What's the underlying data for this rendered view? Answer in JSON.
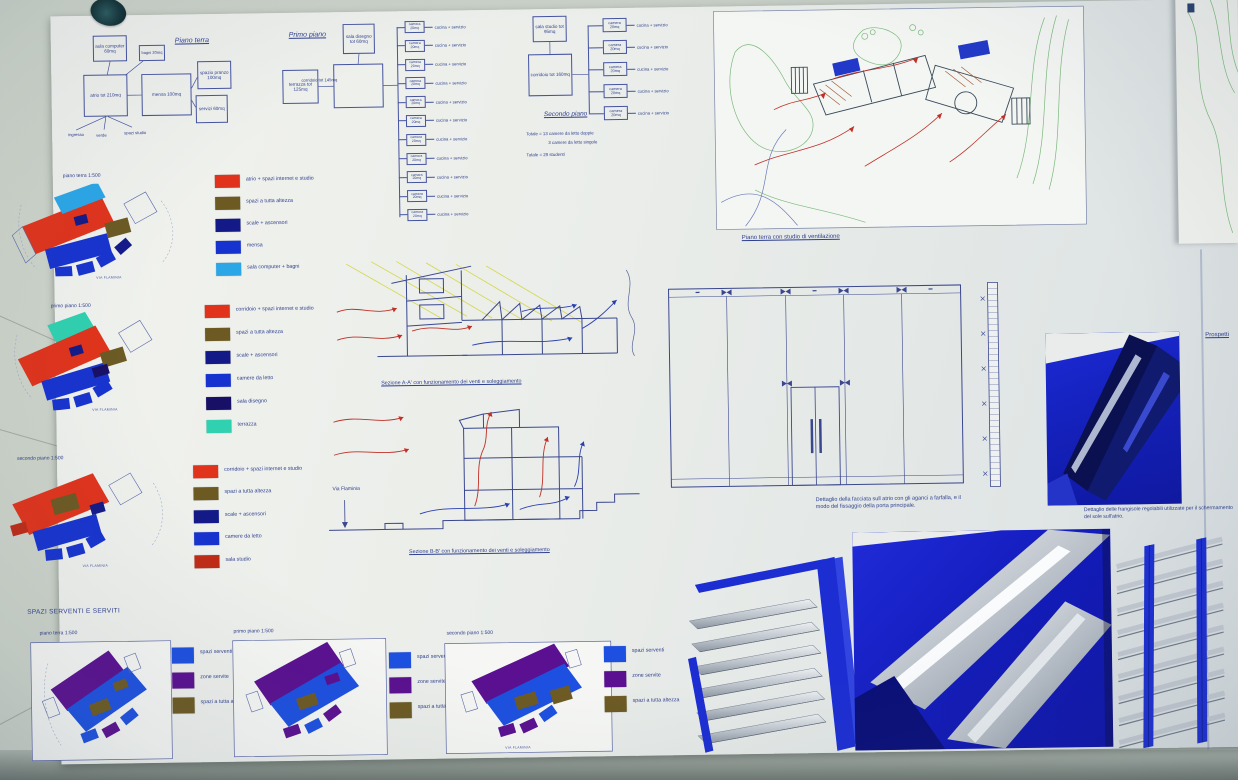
{
  "ink": "#2e3f8e",
  "org_piano_terra": {
    "title": "Piano terra",
    "rooms": {
      "aula": "aula computer 60mq",
      "bagni": "bagni 20mq",
      "atrio": "atrio tot 210mq",
      "mensa": "mensa 100mq",
      "pranzo": "spazio pranzo 100mq",
      "servizi": "servizi 60mq"
    },
    "stubs": [
      "ingresso",
      "verde",
      "spazi studio"
    ]
  },
  "org_primo_piano": {
    "title": "Primo piano",
    "rooms": {
      "sala_disegno": "sala disegno tot 60mq",
      "terrazza": "terrazza tot 125mq",
      "corridoio": "corridoio tot 145mq"
    },
    "camera_rows": [
      {
        "room": "camera 20mq",
        "service": "cucina + servizio"
      },
      {
        "room": "camera 20mq",
        "service": "cucina + servizio"
      },
      {
        "room": "camera 20mq",
        "service": "cucina + servizio"
      },
      {
        "room": "camera 20mq",
        "service": "cucina + servizio"
      },
      {
        "room": "camera 20mq",
        "service": "cucina + servizio"
      },
      {
        "room": "camera 20mq",
        "service": "cucina + servizio"
      },
      {
        "room": "camera 20mq",
        "service": "cucina + servizio"
      },
      {
        "room": "camera 20mq",
        "service": "cucina + servizio"
      },
      {
        "room": "camera 20mq",
        "service": "cucina + servizio"
      },
      {
        "room": "camera 20mq",
        "service": "cucina + servizio"
      },
      {
        "room": "camera 20mq",
        "service": "cucina + servizio"
      }
    ]
  },
  "org_secondo_piano": {
    "title": "Secondo piano",
    "rooms": {
      "sala_studio": "sala studio tot 95mq",
      "corridoio": "corridoio tot 160mq"
    },
    "camera_rows": [
      {
        "room": "camera 20mq",
        "service": "cucina + servizio"
      },
      {
        "room": "camera 20mq",
        "service": "cucina + servizio"
      },
      {
        "room": "camera 20mq",
        "service": "cucina + servizio"
      },
      {
        "room": "camera 20mq",
        "service": "cucina + servizio"
      },
      {
        "room": "camera 20mq",
        "service": "cucina + servizio"
      }
    ],
    "totals": {
      "line1": "Totale = 13 camere da letto doppie",
      "line2": "3 camere da letto singole",
      "line3": "Totale = 29 studenti"
    }
  },
  "site_plan": {
    "caption": "Piano terra con studio di ventilazione"
  },
  "colored_plans": [
    {
      "label": "piano terra 1:500",
      "road": "VIA FLAMINIA",
      "legend": [
        {
          "color": "#e1331b",
          "label": "atrio + spazi internet e studio"
        },
        {
          "color": "#6d5a23",
          "label": "spazi a tutta altezza"
        },
        {
          "color": "#131a88",
          "label": "scale + ascensori"
        },
        {
          "color": "#1733cf",
          "label": "mensa"
        },
        {
          "color": "#2ba7e8",
          "label": "sala computer + bagni"
        }
      ]
    },
    {
      "label": "primo piano 1:500",
      "road": "VIA FLAMINIA",
      "legend": [
        {
          "color": "#e1331b",
          "label": "corridoio + spazi internet e studio"
        },
        {
          "color": "#6d5a23",
          "label": "spazi a tutta altezza"
        },
        {
          "color": "#131a88",
          "label": "scale + ascensori"
        },
        {
          "color": "#1733cf",
          "label": "camere da letto"
        },
        {
          "color": "#171066",
          "label": "sala disegno"
        },
        {
          "color": "#2fd1b0",
          "label": "terrazza"
        }
      ]
    },
    {
      "label": "secondo piano 1:500",
      "road": "VIA FLAMINIA",
      "legend": [
        {
          "color": "#e1331b",
          "label": "corridoio + spazi internet e studio"
        },
        {
          "color": "#6d5a23",
          "label": "spazi a tutta altezza"
        },
        {
          "color": "#131a88",
          "label": "scale + ascensori"
        },
        {
          "color": "#1733cf",
          "label": "camere da letto"
        },
        {
          "color": "#bf2b17",
          "label": "sala studio"
        }
      ]
    }
  ],
  "sections": {
    "caption_a": "Sezione A-A' con funzionamento dei venti e soleggiamento",
    "caption_b": "Sezione B-B' con funzionamento dei venti e soleggiamento",
    "via_flaminia": "Via Flaminia"
  },
  "facade_detail": {
    "caption": "Dettaglio della facciata sull atrio con gli aganci a farfalla, e il modo del fissaggio della porta principale."
  },
  "frangisole": {
    "caption": "Dettaglio delle frangisole regolabili utilizzate per il schermamento del sole sull'atrio."
  },
  "serventi": {
    "heading": "SPAZI SERVENTI E SERVITI",
    "road": "VIA FLAMINIA",
    "plans": [
      {
        "label": "piano terra 1:500"
      },
      {
        "label": "primo piano 1:500"
      },
      {
        "label": "secondo piano 1:500"
      }
    ],
    "legend": [
      {
        "color": "#1d50e0",
        "label": "spazi serventi"
      },
      {
        "color": "#5a1090",
        "label": "zone servite"
      },
      {
        "color": "#6d5a23",
        "label": "spazi a tutta altezza"
      }
    ]
  },
  "edge": {
    "prospetti": "Prospetti"
  }
}
